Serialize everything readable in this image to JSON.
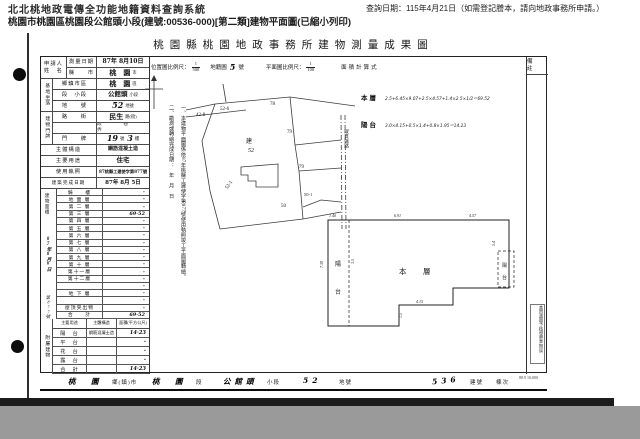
{
  "header": {
    "system_title": "北北桃地政電傳全功能地籍資料查詢系統",
    "query_date": "查詢日期：115年4月21日（如需登記謄本，請向地政事務所申請。）",
    "subtitle": "桃園市桃園區桃園段公館頭小段(建號:00536-000)[第二類]建物平面圖(已縮小列印)"
  },
  "doc": {
    "title": "桃園縣桃園地政事務所建物測量成果圖",
    "scale": {
      "loc_label": "位置圖比例尺：",
      "loc_num": "1",
      "loc_den": "500",
      "cad_label": "地籍圖",
      "cad_no": "5",
      "cad_suffix": "號",
      "plan_label": "平面圖比例尺：",
      "plan_num": "1",
      "plan_den": "100",
      "calc_label": "面積計算式"
    },
    "applicant": {
      "line1": "申請人",
      "line2": "姓　名"
    },
    "spine_site": "基地坐落",
    "spine_door": "建物門牌",
    "info_rows": [
      {
        "label": "測量日期",
        "value": "87年 8月10日",
        "suffix": ""
      },
      {
        "label": "縣　　市",
        "value": "桃　園",
        "suffix": "市"
      },
      {
        "label": "鄉鎮市區",
        "value": "桃　園",
        "suffix": "區"
      },
      {
        "label": "段　小段",
        "value": "公館頭",
        "suffix": "小段"
      },
      {
        "label": "地　　號",
        "value": "52",
        "suffix": "地號"
      },
      {
        "label": "路　　街",
        "value": "民生",
        "suffix": "路(街)"
      },
      {
        "label": "",
        "value": "段　　巷　　弄",
        "suffix": ""
      },
      {
        "label": "門　　牌",
        "value": "19",
        "suffix": "號",
        "value2": "3",
        "suffix2": "樓"
      },
      {
        "label": "主體構造",
        "value": "鋼筋混凝土造",
        "suffix": ""
      },
      {
        "label": "主要用途",
        "value": "住宅",
        "suffix": ""
      },
      {
        "label": "使用執照",
        "value": "87桃縣工建使字第877號",
        "suffix": ""
      },
      {
        "label": "建築完成日期",
        "value": "87年 8月 5日",
        "suffix": ""
      }
    ],
    "receipt": {
      "col_label": "建物面積",
      "date": "87年8月6日",
      "no": "第877號"
    },
    "floors": [
      {
        "n": "騎　　樓",
        "a": "-"
      },
      {
        "n": "地 面 層",
        "a": "-"
      },
      {
        "n": "第 二 層",
        "a": "-"
      },
      {
        "n": "第 三 層",
        "a": "69·52"
      },
      {
        "n": "第 四 層",
        "a": "-"
      },
      {
        "n": "第 五 層",
        "a": "-"
      },
      {
        "n": "第 六 層",
        "a": "-"
      },
      {
        "n": "第 七 層",
        "a": "-"
      },
      {
        "n": "第 八 層",
        "a": "-"
      },
      {
        "n": "第 九 層",
        "a": "-"
      },
      {
        "n": "第 十 層",
        "a": "-"
      },
      {
        "n": "第十一層",
        "a": "-"
      },
      {
        "n": "第十二層",
        "a": "-"
      },
      {
        "n": "",
        "a": "-"
      },
      {
        "n": "地 下 層",
        "a": "-"
      },
      {
        "n": "",
        "a": "-"
      },
      {
        "n": "屋頂突出物",
        "a": "-"
      },
      {
        "n": "合　　計",
        "a": "69·52"
      }
    ],
    "attached": {
      "spine": "附屬建物",
      "headers": [
        "主要用途",
        "主體構造",
        "面積(平方公尺)"
      ],
      "rows": [
        {
          "u": "陽　台",
          "s": "鋼筋混凝土造",
          "a": "14·23"
        },
        {
          "u": "平　台",
          "s": "",
          "a": "-"
        },
        {
          "u": "花　台",
          "s": "",
          "a": "-"
        },
        {
          "u": "露　台",
          "s": "",
          "a": "-"
        },
        {
          "u": "合　計",
          "s": "",
          "a": "14·23"
        }
      ]
    },
    "notes": [
      "一、本建物平面圖係依87年桃縣工建使字第877號使用執照竣工平面圖轉繪。",
      "二、勘測或轉繪完成日期：　年　月　日"
    ],
    "calc": [
      {
        "label": "本層",
        "formula": "2.5+6.45×9.07+2.5×4.57+1.4×2.5×1/2＝69.52"
      },
      {
        "label": "陽台",
        "formula": "3.0×4.15+0.5×1.4+0.8×1.95＝14.23"
      }
    ],
    "map_labels": [
      "42-8",
      "52-6",
      "78",
      "79",
      "建",
      "52",
      "79",
      "52-1",
      "50",
      "50-1"
    ],
    "map_road": "縱貫鐵路",
    "plan": {
      "left_balcony_1": "陽",
      "left_balcony_2": "台",
      "main_1": "本",
      "main_2": "層",
      "right_balcony_1": "陽",
      "right_balcony_2": "台",
      "dims": [
        "1.40",
        "6.91",
        "4.57",
        "7.30",
        "3.5",
        "5.4",
        "4.15",
        "1.5"
      ]
    },
    "remarks_header": "備　註",
    "stamp": "本實測圖予核發謄本無誤",
    "footer": {
      "t1": "桃　園",
      "t2": "鄉(鎮)市",
      "t3": "桃　園",
      "t4": "段",
      "t5": "公館頭",
      "t6": "小段",
      "t7": "52",
      "t8": "地號",
      "t9": "536",
      "t10": "建號",
      "t11": "棟次"
    },
    "print_code": "88.9 10,000"
  }
}
